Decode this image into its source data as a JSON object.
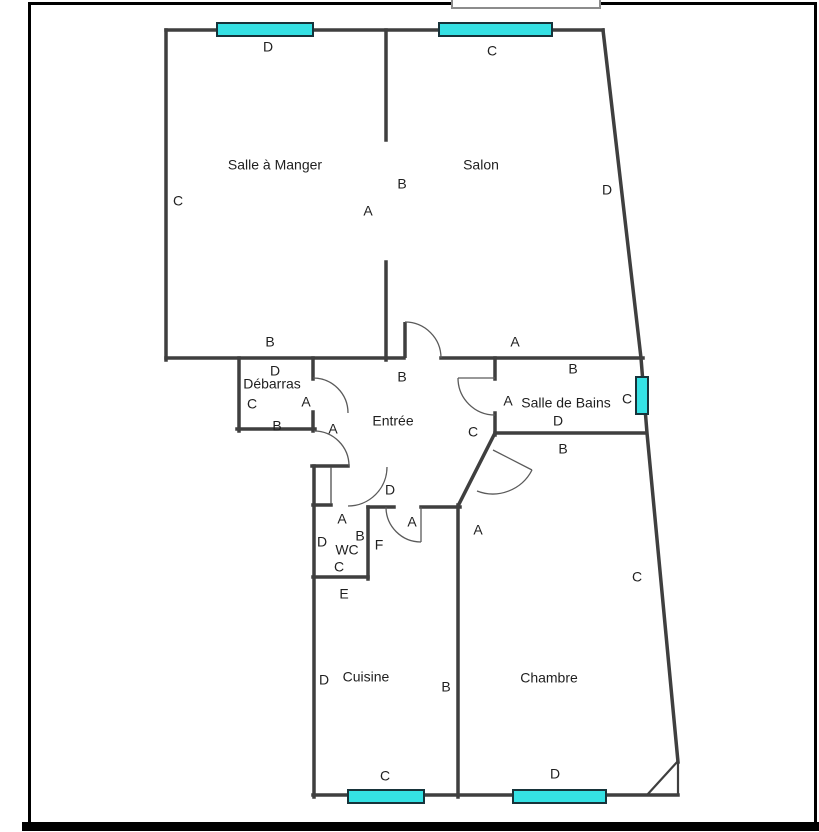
{
  "figure": {
    "type": "apartment floor plan",
    "language": "French"
  },
  "colors": {
    "wall": "#3f3f3f",
    "thin_line": "#5a5a5a",
    "window_fill": "#35e1e4",
    "window_stroke": "#17333a",
    "frame": "#000000",
    "text": "#1f1f1f",
    "notch": "#8c8c8c"
  },
  "rooms": [
    {
      "id": "salle-a-manger",
      "name": "Salle à Manger",
      "x": 275,
      "y": 166
    },
    {
      "id": "salon",
      "name": "Salon",
      "x": 481,
      "y": 166
    },
    {
      "id": "debarras",
      "name": "Débarras",
      "x": 272,
      "y": 385
    },
    {
      "id": "entree",
      "name": "Entrée",
      "x": 393,
      "y": 422
    },
    {
      "id": "salle-de-bains",
      "name": "Salle de Bains",
      "x": 566,
      "y": 404
    },
    {
      "id": "wc",
      "name": "WC",
      "x": 347,
      "y": 551
    },
    {
      "id": "cuisine",
      "name": "Cuisine",
      "x": 366,
      "y": 678
    },
    {
      "id": "chambre",
      "name": "Chambre",
      "x": 549,
      "y": 679
    }
  ],
  "wall_labels": [
    {
      "text": "D",
      "x": 268,
      "y": 48
    },
    {
      "text": "C",
      "x": 492,
      "y": 52
    },
    {
      "text": "C",
      "x": 178,
      "y": 202
    },
    {
      "text": "B",
      "x": 402,
      "y": 185
    },
    {
      "text": "A",
      "x": 368,
      "y": 212
    },
    {
      "text": "D",
      "x": 607,
      "y": 191
    },
    {
      "text": "B",
      "x": 270,
      "y": 343
    },
    {
      "text": "A",
      "x": 515,
      "y": 343
    },
    {
      "text": "B",
      "x": 573,
      "y": 370
    },
    {
      "text": "D",
      "x": 275,
      "y": 372
    },
    {
      "text": "C",
      "x": 252,
      "y": 405
    },
    {
      "text": "A",
      "x": 306,
      "y": 403
    },
    {
      "text": "B",
      "x": 277,
      "y": 427
    },
    {
      "text": "A",
      "x": 333,
      "y": 430
    },
    {
      "text": "B",
      "x": 402,
      "y": 378
    },
    {
      "text": "A",
      "x": 508,
      "y": 402
    },
    {
      "text": "C",
      "x": 627,
      "y": 400
    },
    {
      "text": "D",
      "x": 558,
      "y": 422
    },
    {
      "text": "B",
      "x": 563,
      "y": 450
    },
    {
      "text": "C",
      "x": 473,
      "y": 433
    },
    {
      "text": "A",
      "x": 478,
      "y": 531
    },
    {
      "text": "D",
      "x": 390,
      "y": 491
    },
    {
      "text": "A",
      "x": 412,
      "y": 523
    },
    {
      "text": "A",
      "x": 342,
      "y": 520
    },
    {
      "text": "D",
      "x": 322,
      "y": 543
    },
    {
      "text": "B",
      "x": 360,
      "y": 537
    },
    {
      "text": "C",
      "x": 339,
      "y": 568
    },
    {
      "text": "F",
      "x": 379,
      "y": 546
    },
    {
      "text": "E",
      "x": 344,
      "y": 595
    },
    {
      "text": "D",
      "x": 324,
      "y": 681
    },
    {
      "text": "B",
      "x": 446,
      "y": 688
    },
    {
      "text": "C",
      "x": 385,
      "y": 777
    },
    {
      "text": "D",
      "x": 555,
      "y": 775
    },
    {
      "text": "C",
      "x": 637,
      "y": 578
    }
  ],
  "windows": [
    {
      "id": "salle-a-manger",
      "x": 217,
      "y": 23,
      "w": 96,
      "h": 13
    },
    {
      "id": "salon",
      "x": 439,
      "y": 23,
      "w": 113,
      "h": 13
    },
    {
      "id": "salle-de-bains",
      "x": 636,
      "y": 377,
      "w": 12,
      "h": 37
    },
    {
      "id": "cuisine",
      "x": 348,
      "y": 790,
      "w": 76,
      "h": 13
    },
    {
      "id": "chambre",
      "x": 513,
      "y": 790,
      "w": 93,
      "h": 13
    }
  ]
}
